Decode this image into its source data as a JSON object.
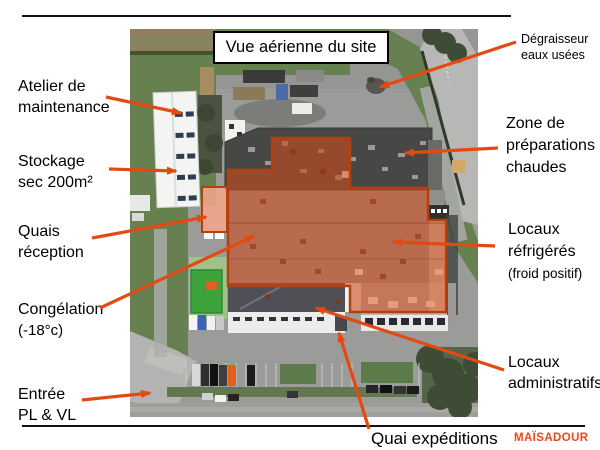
{
  "slide": {
    "title": "Vue aérienne du site",
    "brand": "MAÏSADOUR"
  },
  "labels": {
    "atelier": {
      "lines": [
        "Atelier de",
        "maintenance"
      ]
    },
    "stockage": {
      "lines": [
        "Stockage",
        "sec 200m²"
      ]
    },
    "quais": {
      "lines": [
        "Quais",
        "réception"
      ]
    },
    "congelation": {
      "lines": [
        "Congélation",
        "(-18°c)"
      ]
    },
    "entree": {
      "lines": [
        "Entrée",
        "PL & VL"
      ]
    },
    "degraisseur": {
      "lines": [
        "Dégraisseur",
        "eaux usées"
      ]
    },
    "zone_preparations": {
      "lines": [
        "Zone de",
        "préparations",
        "chaudes"
      ]
    },
    "locaux_refrigeres": {
      "lines": [
        "Locaux",
        "réfrigérés",
        "(froid positif)"
      ]
    },
    "locaux_administratifs": {
      "lines": [
        "Locaux",
        "administratifs"
      ]
    },
    "quai_expeditions": {
      "text": "Quai expéditions"
    }
  },
  "colors": {
    "arrow": "#e24a12",
    "brand": "#e8491a",
    "main_overlay_fill": "#cd4b1e",
    "overlay_border": "#b5400f",
    "quais_overlay_fill": "#f4a88a",
    "congelation_green": "#3da23c",
    "grass": "#6b8256",
    "asphalt": "#9b9c9a"
  },
  "map_regions": [
    "atelier-maintenance-building",
    "stockage-sec-building",
    "quais-reception-overlay",
    "congelation-overlay",
    "entree-pl-vl-road",
    "degraisseur-spot",
    "zone-preparations-chaudes-building",
    "locaux-refrigeres-overlay",
    "locaux-administratifs-building",
    "quai-expeditions-dock"
  ]
}
